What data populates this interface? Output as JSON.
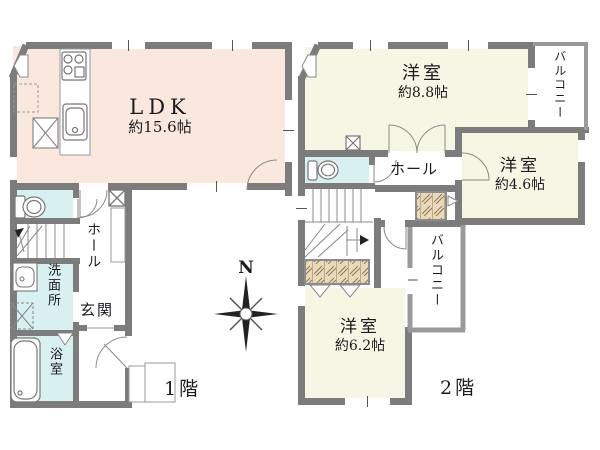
{
  "floor1": {
    "label": "1階",
    "ldk": {
      "name": "LDK",
      "area": "約15.6帖"
    },
    "hall": "ホール",
    "entrance": "玄関",
    "washroom": "洗面所",
    "bathroom": "浴室"
  },
  "floor2": {
    "label": "2階",
    "bedroom_large": {
      "name": "洋室",
      "area": "約8.8帖"
    },
    "bedroom_small": {
      "name": "洋室",
      "area": "約4.6帖"
    },
    "bedroom_mid": {
      "name": "洋室",
      "area": "約6.2帖"
    },
    "hall": "ホール",
    "balcony_upper": "バルコニー",
    "balcony_lower": "バルコニー"
  },
  "compass": {
    "north": "N"
  },
  "colors": {
    "ldk": "#fae8de",
    "wet_area": "#d9f0f1",
    "bedroom": "#f5f6e3",
    "closet": "#e9d9ba",
    "wall": "#7c7c7c",
    "balcony_wall": "#9a9a9a",
    "line": "#8a8a8a",
    "text": "#1b1b20"
  }
}
